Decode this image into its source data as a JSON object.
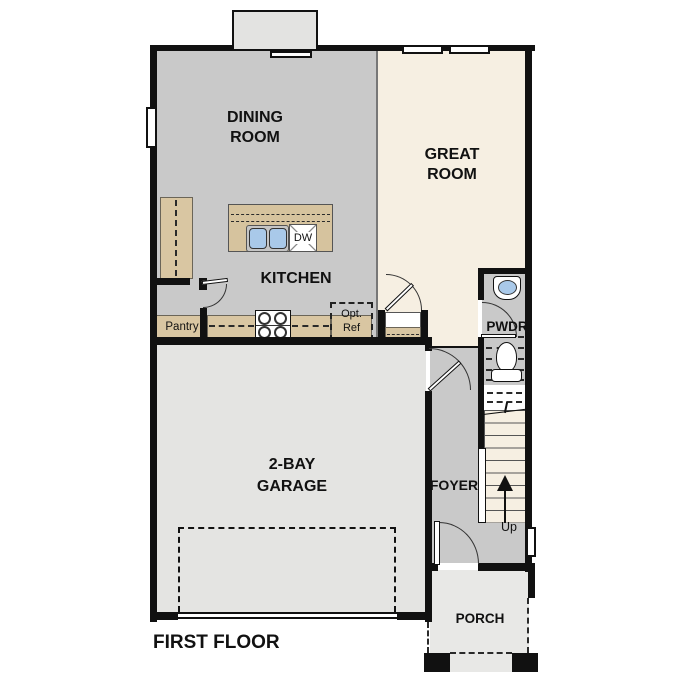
{
  "page_title": "FIRST FLOOR",
  "colors": {
    "wall": "#111111",
    "floor_gray": "#c9c9c9",
    "great_room_cream": "#f6efe2",
    "counter_tan": "#d9c6a2",
    "garage_gray": "#e4e4e2",
    "porch_gray": "#e8e8e6",
    "bay_gray": "#e3e3e1",
    "sink_blue": "#a9c9e9"
  },
  "rooms": {
    "dining": {
      "label": "DINING ROOM"
    },
    "great": {
      "label": "GREAT ROOM"
    },
    "kitchen": {
      "label": "KITCHEN"
    },
    "pantry": {
      "label": "Pantry"
    },
    "powder": {
      "label": "PWDR"
    },
    "foyer": {
      "label": "FOYER"
    },
    "garage": {
      "label": "2-BAY GARAGE"
    },
    "porch": {
      "label": "PORCH"
    }
  },
  "fixtures": {
    "dishwasher_label": "DW",
    "optional_ref_label": "Opt.\nRef",
    "stairs_up_label": "Up"
  }
}
